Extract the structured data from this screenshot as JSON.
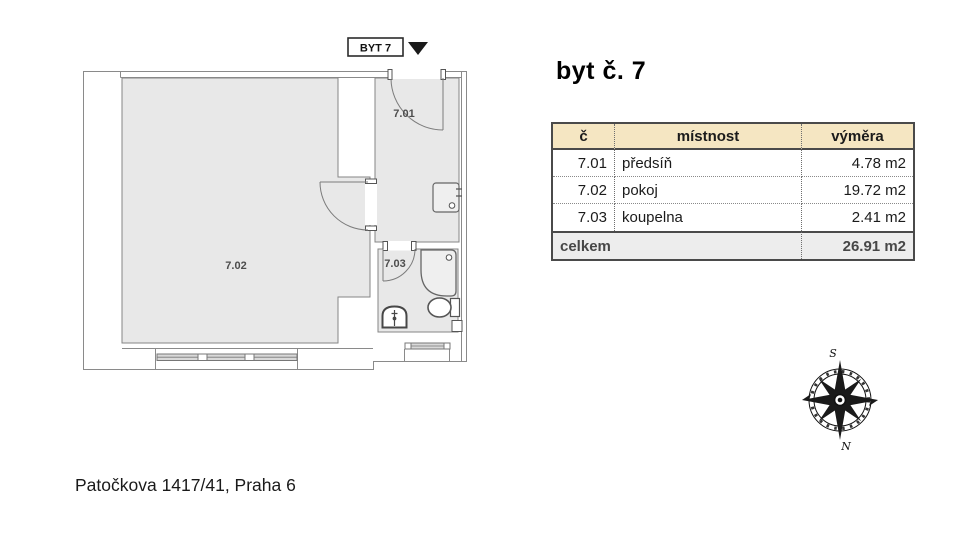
{
  "header": {
    "flat_label": "BYT 7"
  },
  "title": "byt č. 7",
  "plan": {
    "room_labels": {
      "r701": "7.01",
      "r702": "7.02",
      "r703": "7.03"
    }
  },
  "table": {
    "headers": [
      "č",
      "místnost",
      "výměra"
    ],
    "rows": [
      {
        "num": "7.01",
        "room": "předsíň",
        "area": "4.78 m2"
      },
      {
        "num": "7.02",
        "room": "pokoj",
        "area": "19.72 m2"
      },
      {
        "num": "7.03",
        "room": "koupelna",
        "area": "2.41 m2"
      }
    ],
    "total_label": "celkem",
    "total_area": "26.91 m2"
  },
  "compass": {
    "top": "S",
    "bottom": "N"
  },
  "footer": {
    "address": "Patočkova 1417/41, Praha 6"
  },
  "colors": {
    "room_fill": "#e8e8e8",
    "plan_line": "#8a8a8a",
    "fixture_line": "#5a5a5a",
    "window_fill": "#d9d9d9",
    "table_header_bg": "#f5e6c2",
    "table_total_bg": "#ededed",
    "table_border": "#4a4a4a",
    "marker_black": "#1a1a1a"
  }
}
